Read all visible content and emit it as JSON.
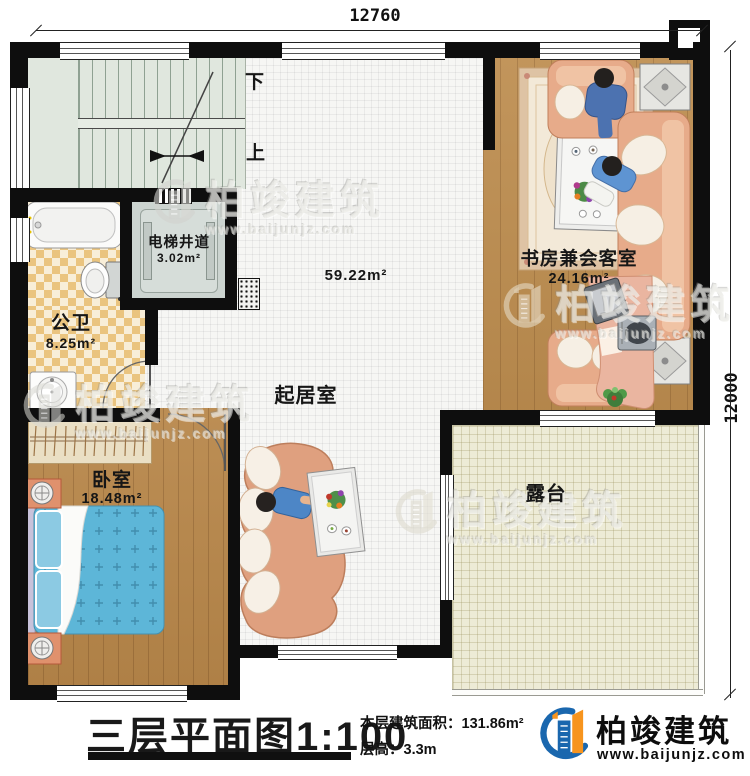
{
  "dimensions": {
    "top": "12760",
    "right": "12000"
  },
  "stairs": {
    "down": "下",
    "up": "上"
  },
  "rooms": {
    "elevator": {
      "name": "电梯井道",
      "area": "3.02m²"
    },
    "bathroom": {
      "name": "公卫",
      "area": "8.25m²"
    },
    "living_room": {
      "name": "起居室",
      "area": "59.22m²"
    },
    "study": {
      "name": "书房兼会客室",
      "area": "24.16m²"
    },
    "bedroom": {
      "name": "卧室",
      "area": "18.48m²"
    },
    "terrace": {
      "name": "露台"
    }
  },
  "title_block": {
    "title": "三层平面图",
    "scale": "1:100",
    "floor_area_label": "本层建筑面积：131.86m²",
    "floor_height_label": "层高：3.3m"
  },
  "logo": {
    "company": "柏竣建筑",
    "website": "www.baijunjz.com"
  },
  "watermark": {
    "company": "柏竣建筑",
    "website": "www.baijunjz.com"
  },
  "colors": {
    "wall": "#0e0e0e",
    "wood_floor": "#b8874a",
    "tile_floor": "#f6f6f4",
    "terrace_floor": "#edebd6",
    "bathroom_tile": "#eac47f",
    "stair_floor": "#e0e7de",
    "bed": "#5db6d8",
    "sofa": "#e7ab8a",
    "logo_blue": "#1a67ae",
    "logo_orange": "#f7941e"
  }
}
